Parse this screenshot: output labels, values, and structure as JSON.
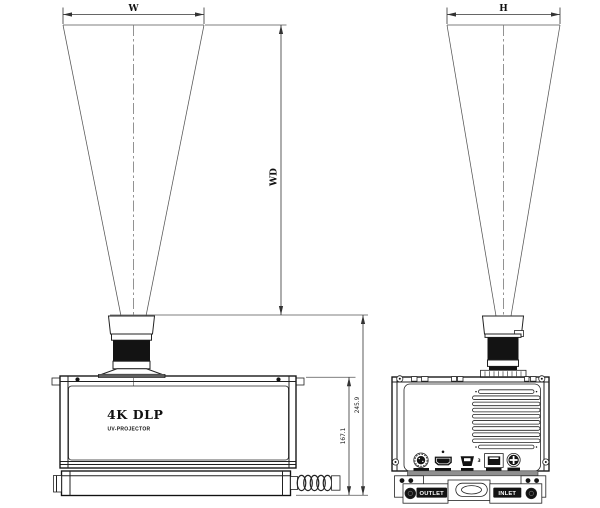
{
  "front_view": {
    "brand_label": "4K DLP",
    "model_label": "UV-PROJECTOR"
  },
  "side_view": {
    "outlet_label": "OUTLET",
    "inlet_label": "INLET",
    "usb3_marking": "3"
  },
  "dimension_labels": {
    "projection_width": "W",
    "projection_height": "H",
    "working_distance": "WD",
    "overall_height": "245.9",
    "body_height": "167.1"
  },
  "colors": {
    "line": "#222222",
    "dark_fill": "#131313",
    "connector_bar": "#8f8f8f",
    "background": "#ffffff"
  }
}
